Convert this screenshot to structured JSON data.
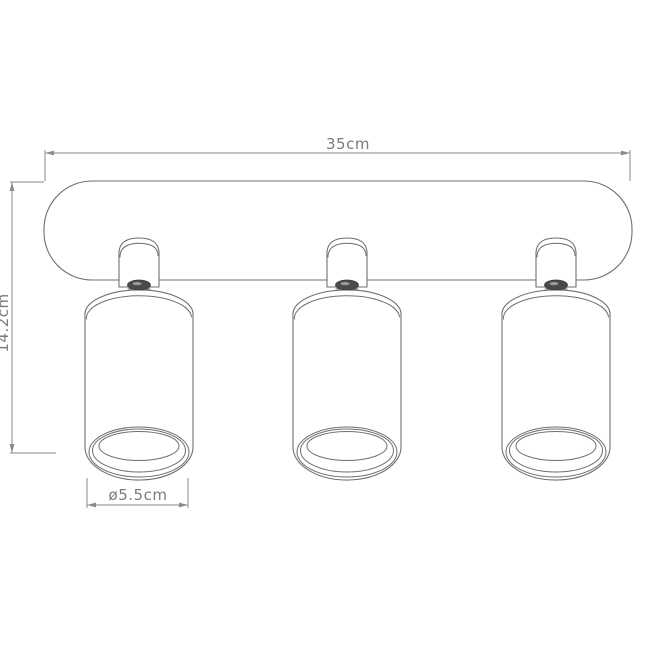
{
  "drawing": {
    "type": "technical-dimension-diagram",
    "spotlight_count": 3,
    "dimensions": {
      "width": {
        "label": "35cm"
      },
      "height": {
        "label": "14.2cm"
      },
      "diameter": {
        "label": "ø5.5cm"
      }
    },
    "colors": {
      "outline": "#6f6f6f",
      "dimension_line": "#8a8a8a",
      "dimension_text": "#7b7b7b",
      "knob": "#4a4a4a",
      "background": "#ffffff"
    }
  }
}
